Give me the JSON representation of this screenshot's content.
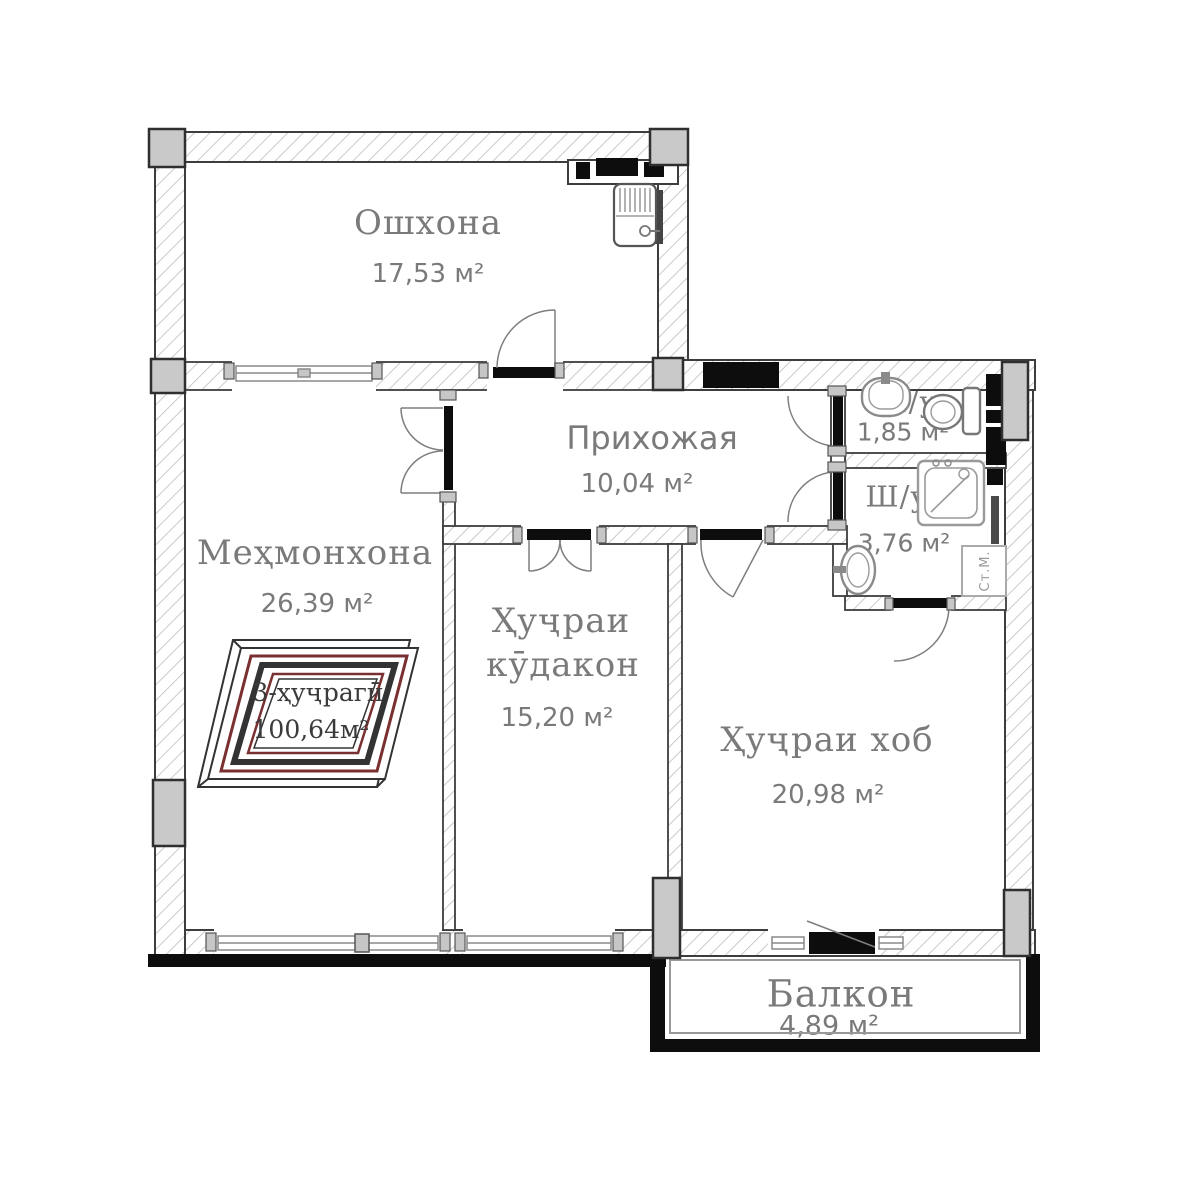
{
  "plan": {
    "rooms": {
      "kitchen": {
        "name": "Ошхона",
        "area": "17,53 м²"
      },
      "hallway": {
        "name": "Прихожая",
        "area": "10,04 м²"
      },
      "living": {
        "name": "Меҳмонхона",
        "area": "26,39 м²"
      },
      "children": {
        "name_line1": "Ҳуҷраи",
        "name_line2": "кӯдакон",
        "area": "15,20 м²"
      },
      "bedroom": {
        "name": "Ҳуҷраи хоб",
        "area": "20,98 м²"
      },
      "bath_small": {
        "name": "Ш/у",
        "area": "1,85 м²"
      },
      "bath_big": {
        "name": "Ш/у",
        "area": "3,76 м²"
      },
      "balcony": {
        "name": "Балкон",
        "area": "4,89 м²"
      }
    },
    "labels": {
      "washing_machine": "Ст.М."
    },
    "logo": {
      "line1": "3-ҳуҷрагӣ",
      "line2": "100,64м²"
    },
    "icons": [
      "kitchen-sink-icon",
      "washbasin-icon",
      "toilet-icon",
      "bathtub-icon",
      "washing-machine-icon",
      "door-swing-icon",
      "window-icon",
      "vent-shaft-icon",
      "column-icon"
    ],
    "colors": {
      "label_gray": "#7a7a7a",
      "wall_border": "#3d3d3d",
      "hatch_line": "#b9b9b9",
      "solid_black": "#0d0d0d",
      "column_fill": "#c9c9c9",
      "fixture_gray": "#8a8a8a",
      "logo_red": "#7a3030",
      "logo_text": "#3b3b3b"
    }
  }
}
